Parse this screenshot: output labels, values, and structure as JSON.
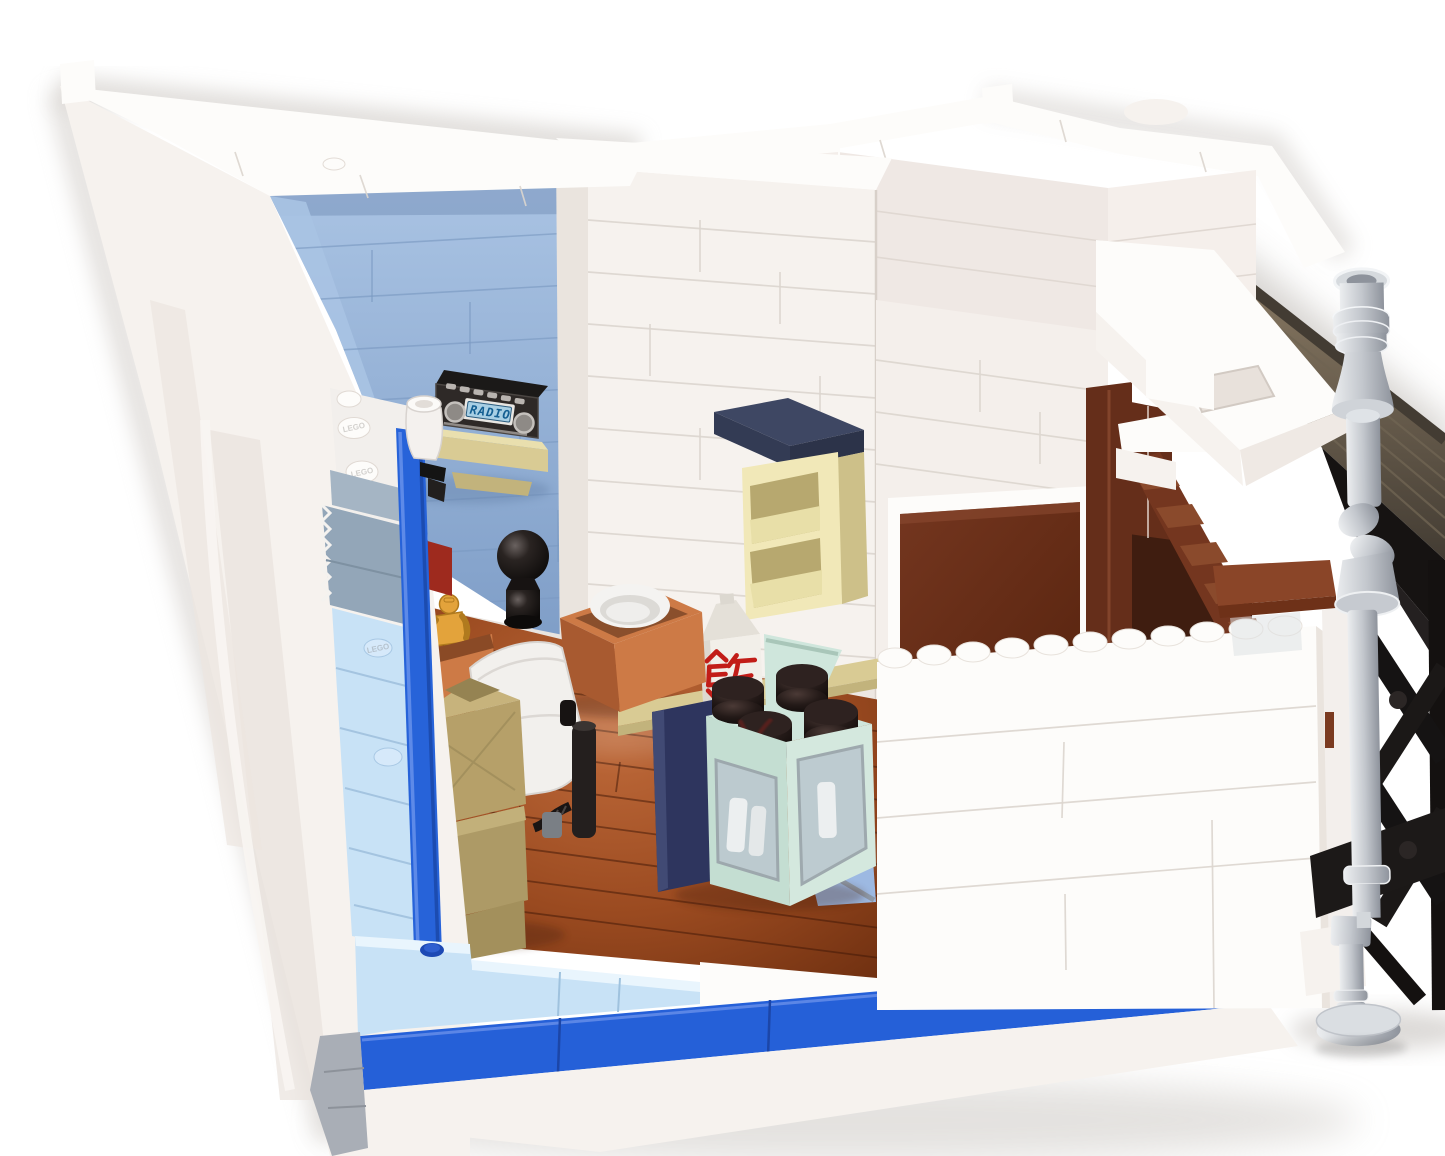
{
  "labels": {
    "radio_display": "RADIO",
    "rice_carton_character": "飯",
    "stud_embossing": "LEGO"
  },
  "colors": {
    "background": "#ffffff",
    "white_bright": "#fdfcfa",
    "white_warm": "#f6f2ee",
    "white_shade": "#eae4de",
    "seam_gray": "#dcd5ce",
    "interior_blue_wall": "#8fafd6",
    "interior_blue_light": "#a9c3e3",
    "interior_blue_dark": "#7d9cc6",
    "accent_blue": "#2560d8",
    "brick_blue_column": "#2763d9",
    "light_blue_brick": "#c8e2f6",
    "light_blue_top": "#e9f5fd",
    "sand_blue": "#93a6b8",
    "gray_base": "#a9aeb6",
    "floor_brown": "#9a4a20",
    "floor_brown_dark": "#6e2f10",
    "floor_brown_light": "#bf6a3a",
    "door_brown": "#74361f",
    "door_brown_dark": "#58240f",
    "jamb_brown": "#652e1a",
    "stair_brown": "#8a4a2c",
    "ledge_brown": "#8a4528",
    "roof_brown": "#8d7d66",
    "roof_dark": "#433c33",
    "black": "#161312",
    "black_gloss": "#2e2927",
    "pipe_gray_light": "#eceef0",
    "pipe_gray": "#c3c7cd",
    "pipe_gray_dark": "#8e939c",
    "shelf_tan": "#d9cb94",
    "shelf_tan_dark": "#c2b37c",
    "cream": "#f1e8b8",
    "cream_dark": "#cdc089",
    "navy_box": "#3e4763",
    "navy_cabinet": "#2e355e",
    "mint": "#cfe6dc",
    "mint_dark": "#b7d4c7",
    "glass": "#bcc9cf",
    "nougat": "#cd7a46",
    "nougat_dark": "#a85a30",
    "gold": "#e3a33b",
    "carton_white": "#f2efe9",
    "red_char": "#c21d18",
    "lcd_bg": "#a8cfe4",
    "lcd_text": "#145f92",
    "tan_box": "#b6a069",
    "tan_box_dark": "#958352",
    "periwinkle": "#9db9e2"
  }
}
